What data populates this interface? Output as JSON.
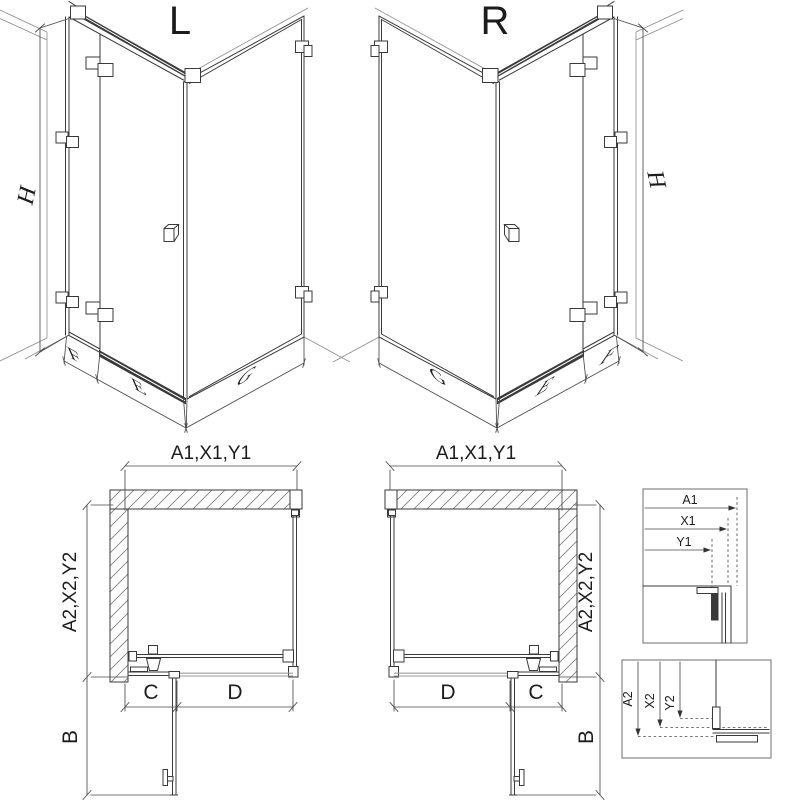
{
  "page": {
    "background": "#ffffff",
    "ink": "#3a3a3a",
    "dim_ink": "#4a4a4a",
    "hatch_ink": "#808080",
    "description": "Technical drawing of corner shower enclosure, left (L) and right (R) variants, with isometric views, plan views and dimension reference details"
  },
  "labels": {
    "variant_left": "L",
    "variant_right": "R",
    "height": "H",
    "fixed_panel_width": "F",
    "door_width": "E",
    "side_panel_width": "G",
    "plan_width": "A1,X1,Y1",
    "plan_depth": "A2,X2,Y2",
    "door_swing_depth": "B",
    "fixed_segment": "C",
    "door_segment": "D"
  },
  "detail_top": {
    "a1": "A1",
    "x1": "X1",
    "y1": "Y1"
  },
  "detail_bottom": {
    "a2": "A2",
    "x2": "X2",
    "y2": "Y2"
  }
}
